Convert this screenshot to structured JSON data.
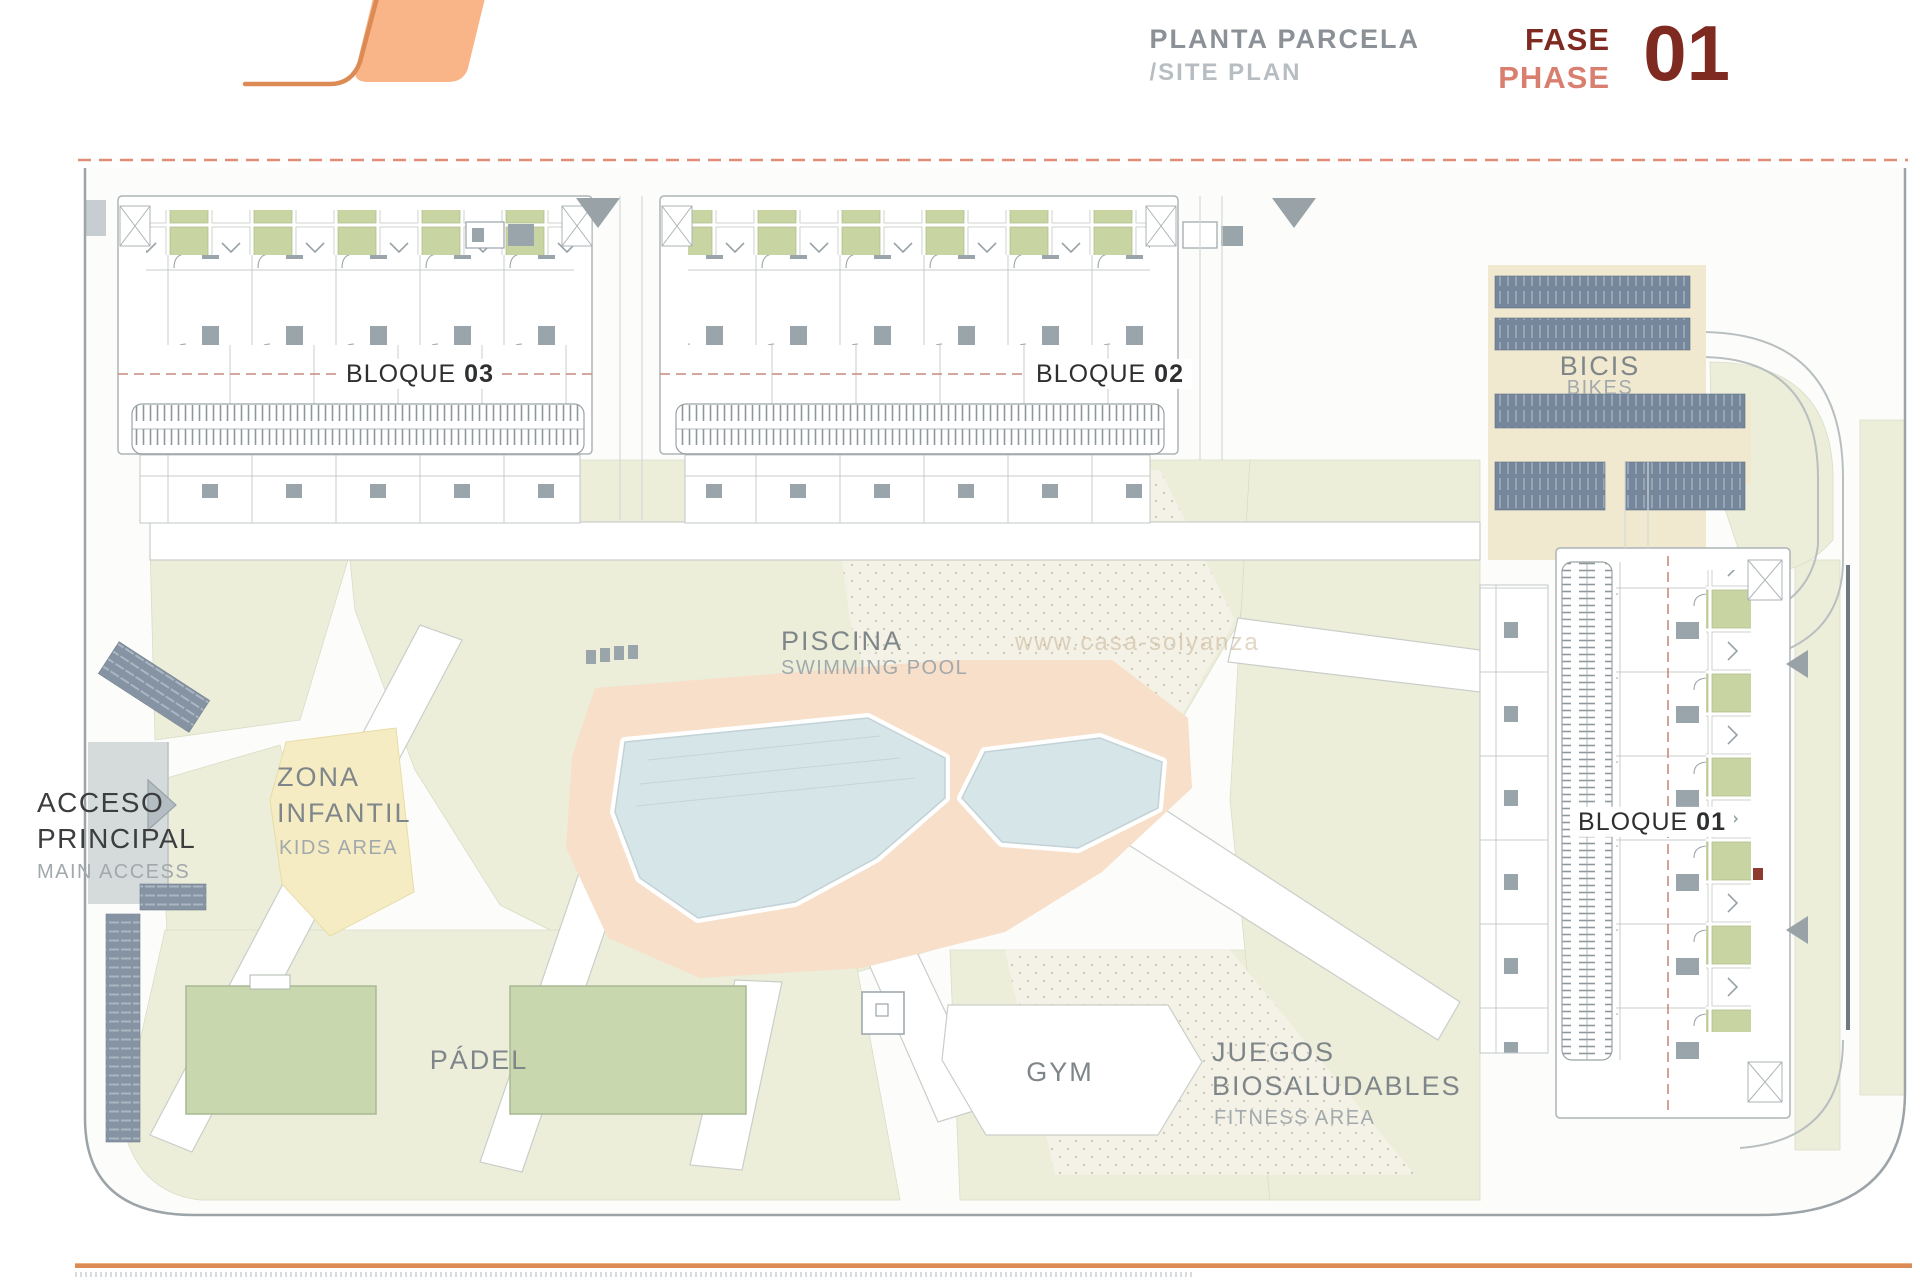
{
  "header": {
    "title_es": "PLANTA PARCELA",
    "title_en": "/SITE PLAN",
    "phase_es": "FASE",
    "phase_en": "PHASE",
    "phase_number": "01"
  },
  "blocks": {
    "b03": {
      "label": "BLOQUE",
      "number": "03"
    },
    "b02": {
      "label": "BLOQUE",
      "number": "02"
    },
    "b01": {
      "label": "BLOQUE",
      "number": "01"
    }
  },
  "areas": {
    "bikes": {
      "es": "BICIS",
      "en": "BIKES"
    },
    "pool": {
      "es": "PISCINA",
      "en": "SWIMMING POOL"
    },
    "kids": {
      "es_line1": "ZONA",
      "es_line2": "INFANTIL",
      "en": "KIDS AREA"
    },
    "access": {
      "es_line1": "ACCESO",
      "es_line2": "PRINCIPAL",
      "en": "MAIN ACCESS"
    },
    "padel": {
      "es": "PÁDEL"
    },
    "gym": {
      "es": "GYM"
    },
    "fitness": {
      "es_line1": "JUEGOS",
      "es_line2": "BIOSALUDABLES",
      "en": "FITNESS AREA"
    }
  },
  "watermark": "www.casa-solyanza",
  "colors": {
    "brand_orange_fill": "#f9b488",
    "brand_orange_line": "#dd8b55",
    "title_gray": "#8b9196",
    "title_light_gray": "#b7bdc0",
    "phase_dark_red": "#7e2a21",
    "phase_salmon": "#d97f70",
    "grass_green": "#eceeda",
    "terrace_green": "#c8d5a3",
    "court_green": "#c9d7ae",
    "pool_water": "#d6e5e8",
    "pool_deck": "#f7dfc9",
    "kids_yellow": "#f6ecc4",
    "bike_rack_blue": "#76879b",
    "sand_tan": "#f0e9cf",
    "boundary_dash_red": "#e08d77"
  }
}
